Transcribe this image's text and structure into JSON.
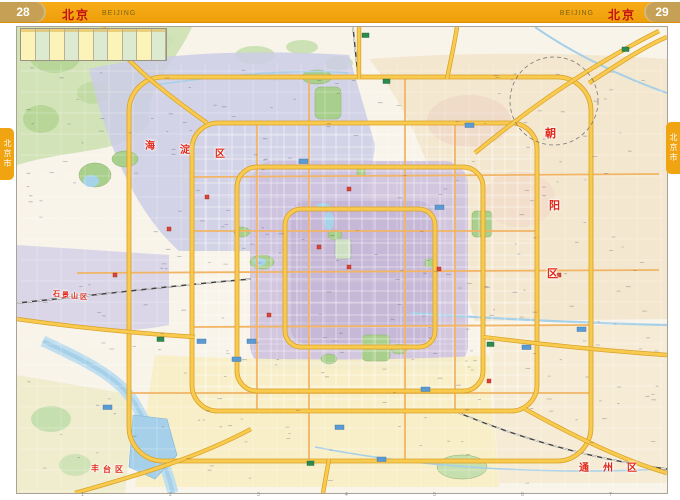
{
  "header": {
    "left_page_number": "28",
    "right_page_number": "29",
    "title_cn": "北京",
    "title_en": "BEIJING"
  },
  "side_tabs": {
    "left_label": "北京市",
    "right_label": "北京市"
  },
  "legend_table": {
    "columns": 10
  },
  "map": {
    "district_labels": [
      {
        "name": "haidian",
        "text": "海淀区",
        "color": "#e02818",
        "size": 10,
        "chars": [
          {
            "ch": "海",
            "x": 128,
            "y": 110
          },
          {
            "ch": "淀",
            "x": 163,
            "y": 114
          },
          {
            "ch": "区",
            "x": 198,
            "y": 118
          }
        ]
      },
      {
        "name": "shijingshan",
        "text": "石景山区",
        "color": "#e02818",
        "size": 7,
        "chars": [
          {
            "ch": "石",
            "x": 36,
            "y": 262
          },
          {
            "ch": "景",
            "x": 45,
            "y": 263
          },
          {
            "ch": "山",
            "x": 54,
            "y": 264
          },
          {
            "ch": "区",
            "x": 63,
            "y": 265
          }
        ]
      },
      {
        "name": "chaoyang",
        "text": "朝阳区",
        "color": "#e02818",
        "size": 11,
        "chars": [
          {
            "ch": "朝",
            "x": 528,
            "y": 98
          },
          {
            "ch": "阳",
            "x": 532,
            "y": 170
          },
          {
            "ch": "区",
            "x": 530,
            "y": 238
          }
        ]
      },
      {
        "name": "fengtai",
        "text": "丰台区",
        "color": "#e02818",
        "size": 8,
        "chars": [
          {
            "ch": "丰",
            "x": 74,
            "y": 436
          },
          {
            "ch": "台",
            "x": 86,
            "y": 437
          },
          {
            "ch": "区",
            "x": 98,
            "y": 437
          }
        ]
      },
      {
        "name": "tongzhou",
        "text": "通州区",
        "color": "#e02818",
        "size": 10,
        "chars": [
          {
            "ch": "通",
            "x": 562,
            "y": 432
          },
          {
            "ch": "州",
            "x": 586,
            "y": 432
          },
          {
            "ch": "区",
            "x": 610,
            "y": 432
          }
        ]
      }
    ],
    "grid_numbers": [
      "1",
      "2",
      "3",
      "4",
      "5",
      "6",
      "7"
    ],
    "colors": {
      "header_orange": "#f2a412",
      "page_tab_gold": "#c6a155",
      "title_red": "#c41111",
      "district_label_red": "#e02818",
      "ring_road_yellow": "#f8cb4f",
      "road_casing": "#d9a128",
      "arterial_orange": "#f2b566",
      "water_blue": "#a6d0ea",
      "park_green": "#a9cf8c",
      "urban_lavender": "#cdcde6",
      "urban_core_purple": "#c4b5d6",
      "urban_tan": "#f3e3c8",
      "urban_yellow": "#f7eec4"
    },
    "markers": {
      "blue": [
        [
          215,
          330
        ],
        [
          230,
          312
        ],
        [
          180,
          312
        ],
        [
          318,
          398
        ],
        [
          404,
          360
        ],
        [
          505,
          318
        ],
        [
          418,
          178
        ],
        [
          282,
          132
        ],
        [
          360,
          430
        ],
        [
          86,
          378
        ],
        [
          448,
          96
        ],
        [
          560,
          300
        ]
      ],
      "red": [
        [
          330,
          238
        ],
        [
          300,
          218
        ],
        [
          420,
          240
        ],
        [
          188,
          168
        ],
        [
          540,
          246
        ],
        [
          96,
          246
        ],
        [
          250,
          286
        ],
        [
          330,
          160
        ],
        [
          470,
          352
        ],
        [
          150,
          200
        ]
      ],
      "green": [
        [
          366,
          52
        ],
        [
          470,
          315
        ],
        [
          290,
          434
        ],
        [
          140,
          310
        ],
        [
          605,
          20
        ],
        [
          345,
          6
        ]
      ]
    }
  }
}
